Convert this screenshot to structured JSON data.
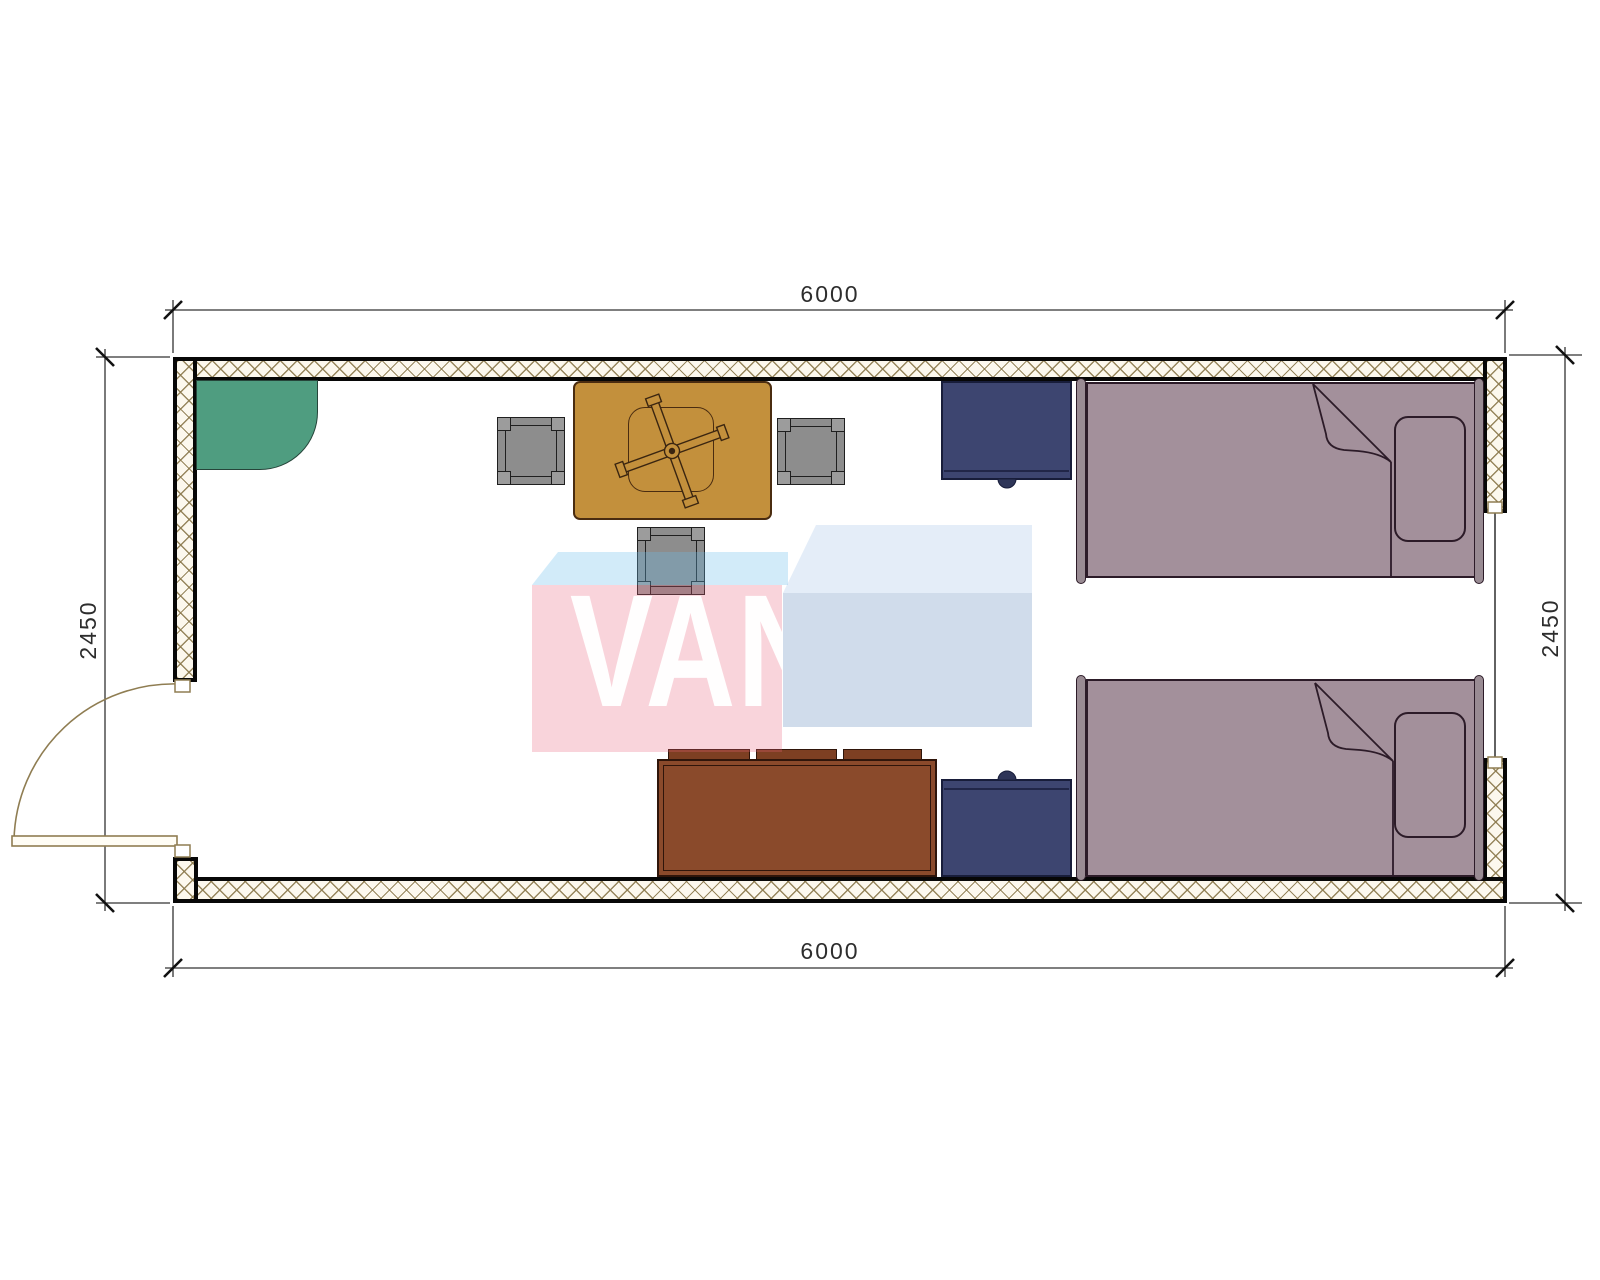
{
  "watermark": {
    "text": "VANDA"
  },
  "dimensions": {
    "width_top": "6000",
    "width_bottom": "6000",
    "height_left": "2450",
    "height_right": "2450"
  },
  "colors": {
    "wall_hatch": "#8c7a4e",
    "corner_unit_green": "#4f9d80",
    "table_gold": "#c3903c",
    "stool_gray": "#8d8d8d",
    "nightstand_navy": "#3d4570",
    "bed_mauve": "#a3909b",
    "sofa_brown": "#8a4a2b",
    "watermark_pink": "#f8d1d9",
    "watermark_blue": "#cdd9ea",
    "dimension_text": "#2d2d2d"
  }
}
